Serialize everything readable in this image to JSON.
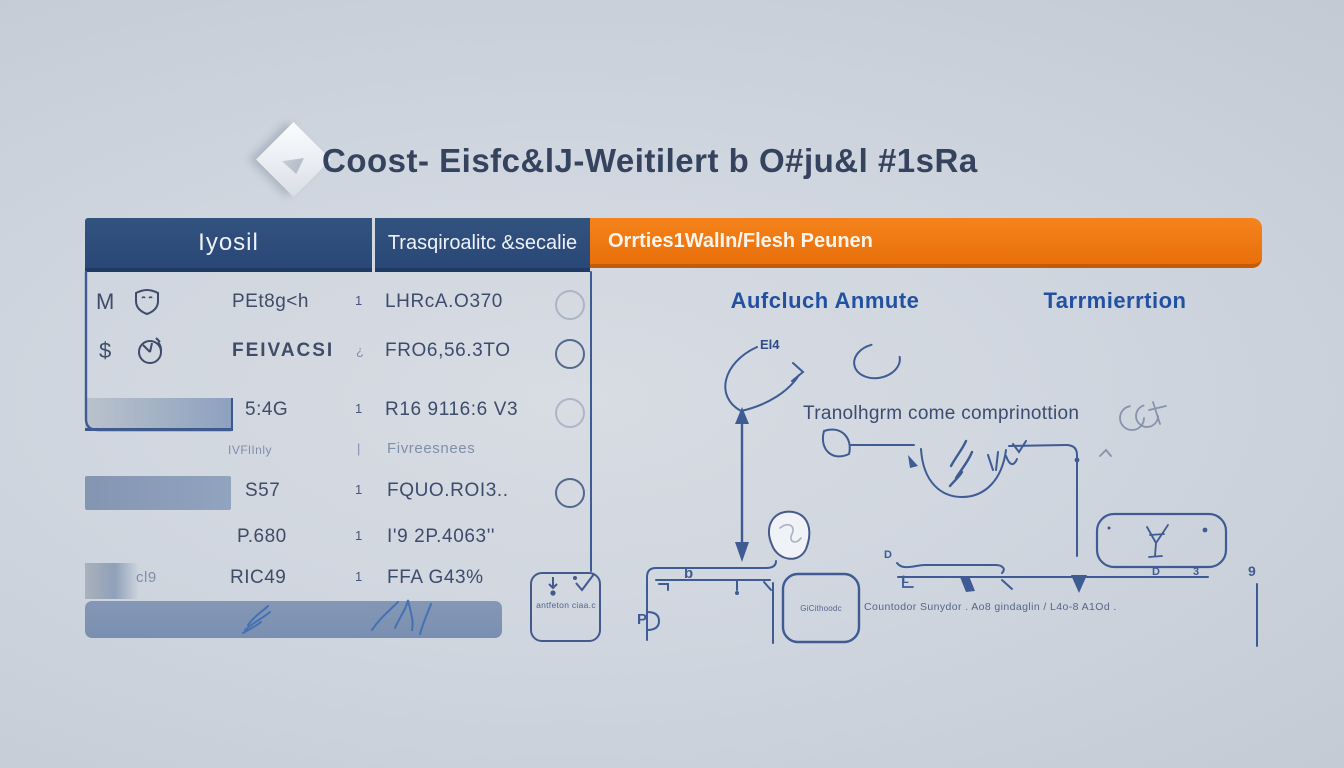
{
  "title": "Coost- Eisfc&lJ-Weitilert b O#ju&l #1sRa",
  "colors": {
    "navy_header": "#2C4B7C",
    "orange_header": "#EE7211",
    "accent_blue": "#2351A1",
    "diagram_line": "#3E5B94",
    "background": "#CDD3DC"
  },
  "table": {
    "header_left": "Iyosil",
    "header_mid": "Trasqiroalitc &secalie",
    "header_orange": "Orrties1WalIn/Flesh Peunen",
    "rows": [
      {
        "icon_letter": "M",
        "icon": "shield-icon",
        "name": "PEt8g<h",
        "qty": "1",
        "value": "LHRcA.O370"
      },
      {
        "icon_letter": "$",
        "icon": "clock-icon",
        "name": "FEIVACSI",
        "qty": "¿",
        "value": "FRO6,56.3TO"
      },
      {
        "name": "5:4G",
        "qty": "1",
        "value": "R16 9116:6 V3"
      },
      {
        "name": "IVFlInly",
        "qty": "|",
        "value": "Fivreesnees"
      },
      {
        "name": "S57",
        "qty": "1",
        "value": "FQUO.ROI3.."
      },
      {
        "name": "P.680",
        "qty": "1",
        "value": "I'9 2P.4063''"
      },
      {
        "prefix": "cl9",
        "name": "RIC49",
        "qty": "1",
        "value": "FFA G43%"
      }
    ],
    "side_box_note": "antfeton ciaa.c"
  },
  "diagram": {
    "col_header_left": "Aufcluch Anmute",
    "col_header_right": "Tarrmierrtion",
    "arc_label": "El4",
    "center_text": "Tranolhgrm come comprinottion",
    "node_label": "GiCithoodc",
    "caption": "Countodor Sunydor . Ao8 gindaglin / L4o-8 A1Od .",
    "glyphs": {
      "b": "b",
      "p": "P",
      "d1": "D",
      "l": "L",
      "d2": "D",
      "three": "3",
      "nine": "9"
    }
  }
}
